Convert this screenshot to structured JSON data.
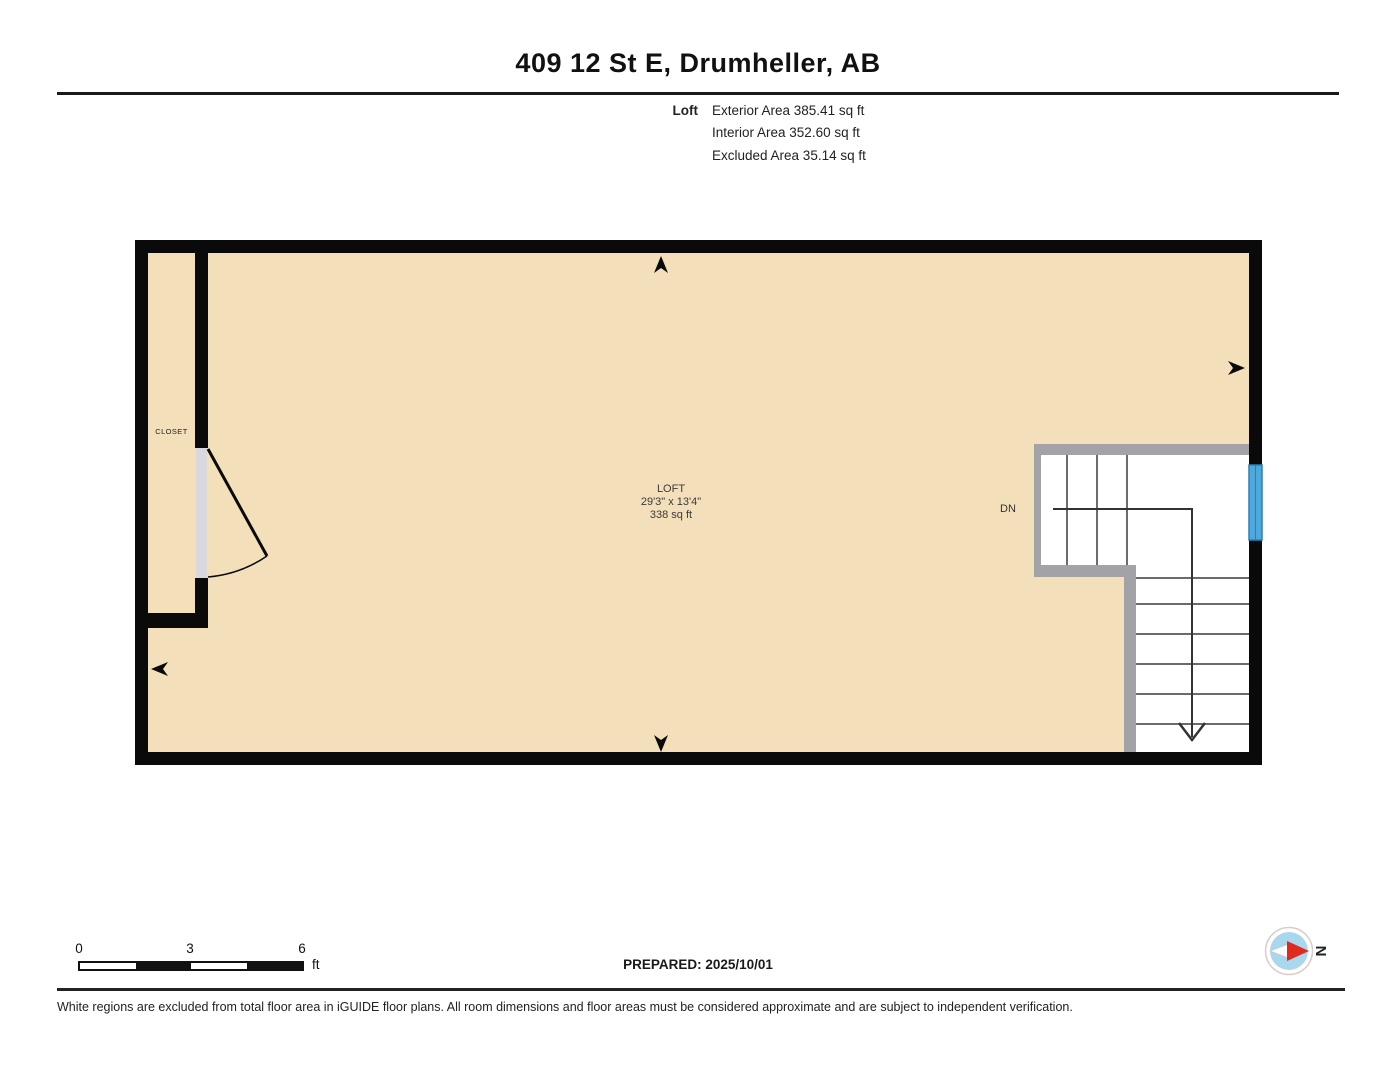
{
  "header": {
    "title": "409 12 St E, Drumheller, AB",
    "floor_label": "Loft",
    "area_rows": [
      "Exterior Area 385.41 sq ft",
      "Interior Area 352.60 sq ft",
      "Excluded Area 35.14 sq ft"
    ]
  },
  "plan": {
    "room": {
      "name": "LOFT",
      "dimensions": "29'3\" x 13'4\"",
      "area": "338 sq ft"
    },
    "closet_label": "CLOSET",
    "stairs_label": "DN",
    "colors": {
      "floor_fill": "#F3DFB9",
      "wall_black": "#0A0A0A",
      "railing_gray": "#A3A3A7",
      "door_gray": "#D8D8DE",
      "window_blue": "#4FA8DC",
      "window_blue_dark": "#2E7FB5",
      "stair_line": "#3A3A3A",
      "compass_blue": "#A9D7EE",
      "compass_red": "#E02A20"
    }
  },
  "scale_bar": {
    "ticks": [
      "0",
      "3",
      "6"
    ],
    "unit": "ft"
  },
  "prepared": {
    "text": "PREPARED: 2025/10/01"
  },
  "compass": {
    "north_label": "N"
  },
  "footer": {
    "disclaimer": "White regions are excluded from total floor area in iGUIDE floor plans. All room dimensions and floor areas must be considered approximate and are subject to independent verification."
  }
}
